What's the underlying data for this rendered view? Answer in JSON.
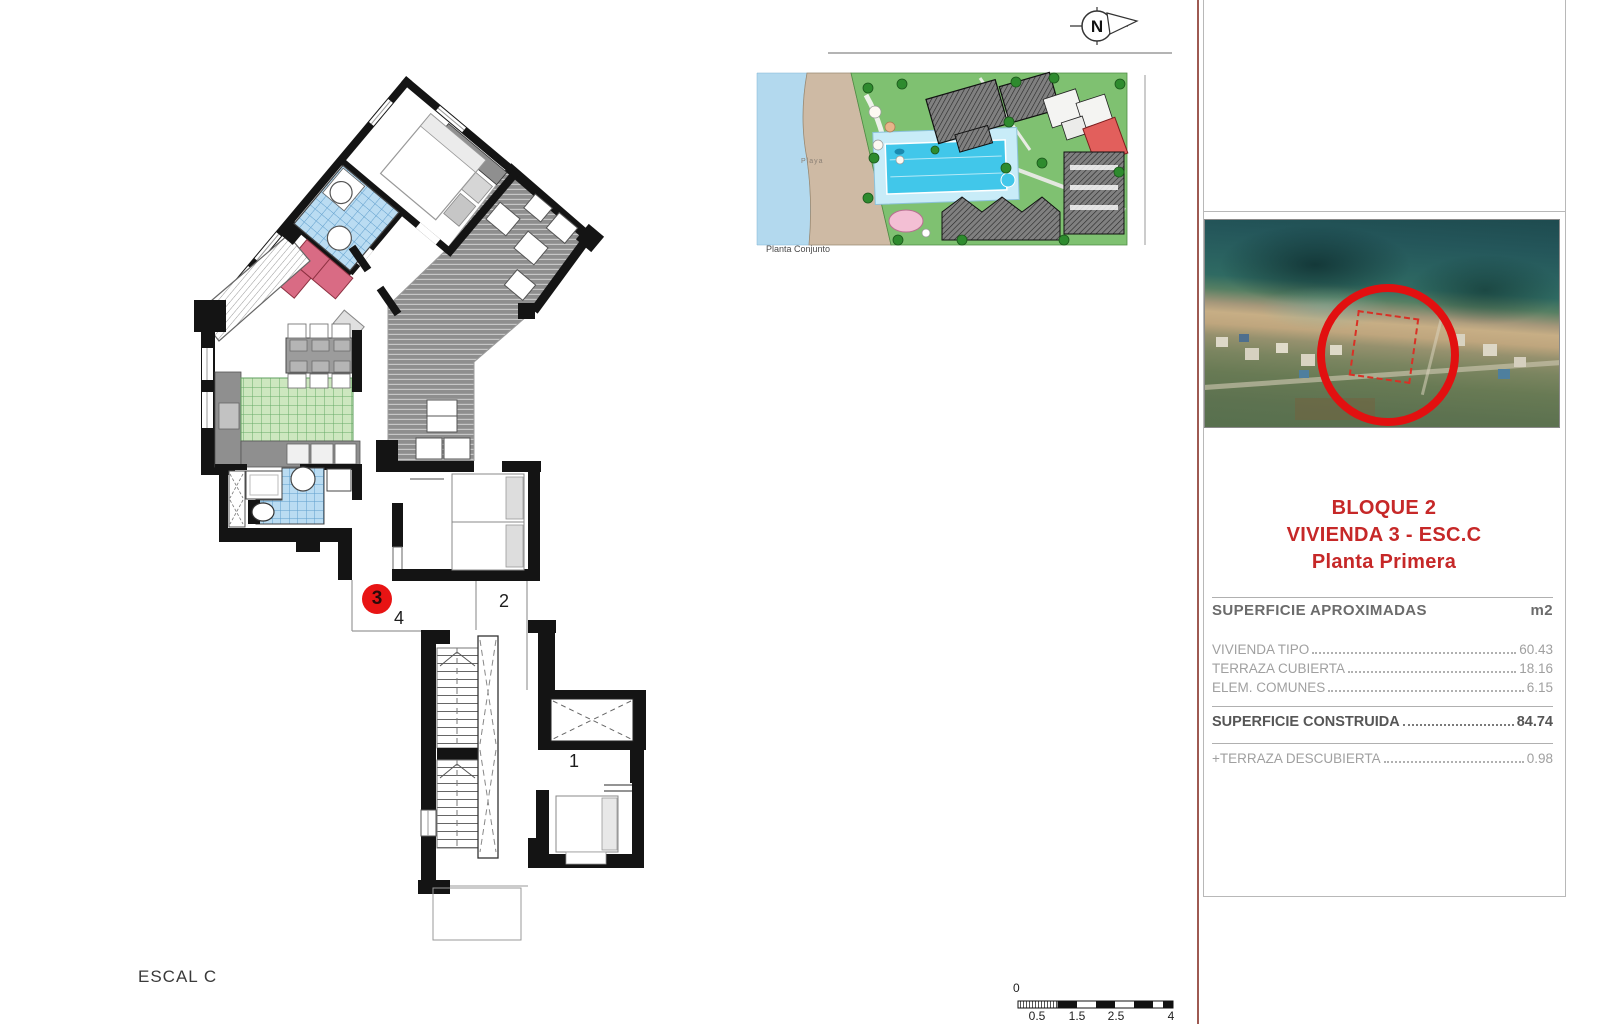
{
  "plan": {
    "escal_label": "ESCAL C",
    "unit_badge": "3",
    "room_1": "1",
    "room_2": "2",
    "room_4": "4"
  },
  "site_plan": {
    "caption": "Planta Conjunto",
    "beach_label": "Playa"
  },
  "compass": {
    "label": "N"
  },
  "panel": {
    "title_line1": "BLOQUE 2",
    "title_line2": "VIVIENDA 3 - ESC.C",
    "title_line3": "Planta Primera",
    "table": {
      "header": "SUPERFICIE APROXIMADAS",
      "unit_label": "m2",
      "rows": [
        {
          "label": "VIVIENDA TIPO",
          "value": "60.43"
        },
        {
          "label": "TERRAZA CUBIERTA",
          "value": "18.16"
        },
        {
          "label": "ELEM. COMUNES",
          "value": "6.15"
        }
      ],
      "total_row": {
        "label": "SUPERFICIE CONSTRUIDA",
        "value": "84.74"
      },
      "extra_row": {
        "label": "+TERRAZA DESCUBIERTA",
        "value": "0.98"
      }
    }
  },
  "scale_bar": {
    "zero_label": "0",
    "tick_labels": [
      "0.5",
      "1.5",
      "2.5",
      "4"
    ]
  },
  "colors": {
    "accent_red_text": "#c62828",
    "badge_red": "#e81414",
    "rule_red": "#9e5a52",
    "wall_black": "#141414",
    "tile_blue": "#badcf2",
    "tile_green": "#cde7bf",
    "terrace_gray": "#8e8e8e",
    "sofa_pink": "#d96b84",
    "sea_blue": "#b3d9ee",
    "beach_tan": "#cebaa4",
    "lawn_green": "#7fc171",
    "pool_cyan": "#41c7ea"
  }
}
